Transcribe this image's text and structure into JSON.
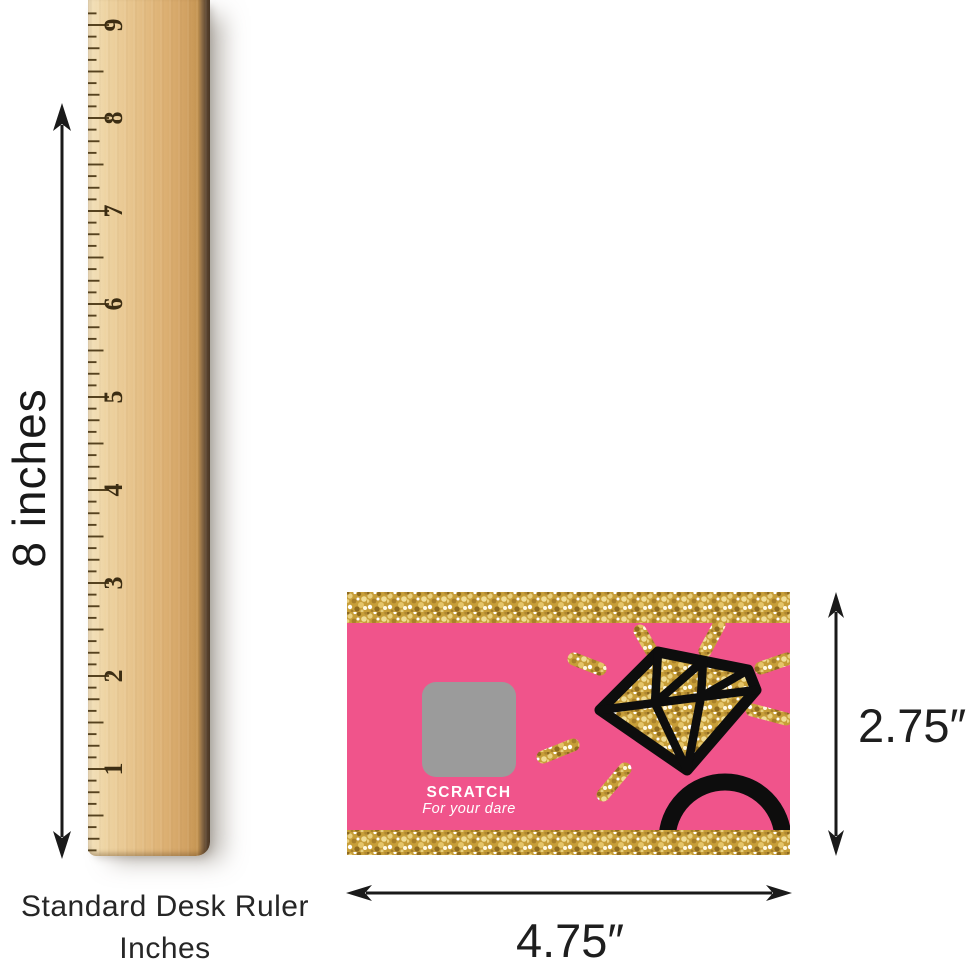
{
  "ruler": {
    "side_label": "8 inches",
    "caption_line1": "Standard Desk Ruler",
    "caption_line2": "Inches",
    "numbers": [
      "1",
      "2",
      "3",
      "4",
      "5",
      "6",
      "7",
      "8",
      "9"
    ],
    "tick_color": "#55421f",
    "number_color": "#3c2d13"
  },
  "card": {
    "scratch_label": "SCRATCH",
    "scratch_sublabel": "For your dare",
    "colors": {
      "pink": "#F0548B",
      "gold": "#C79E38",
      "scratch_gray": "#9B9B9B",
      "ring_black": "#0d0d0d"
    }
  },
  "dimensions": {
    "height_label": "2.75″",
    "width_label": "4.75″"
  }
}
